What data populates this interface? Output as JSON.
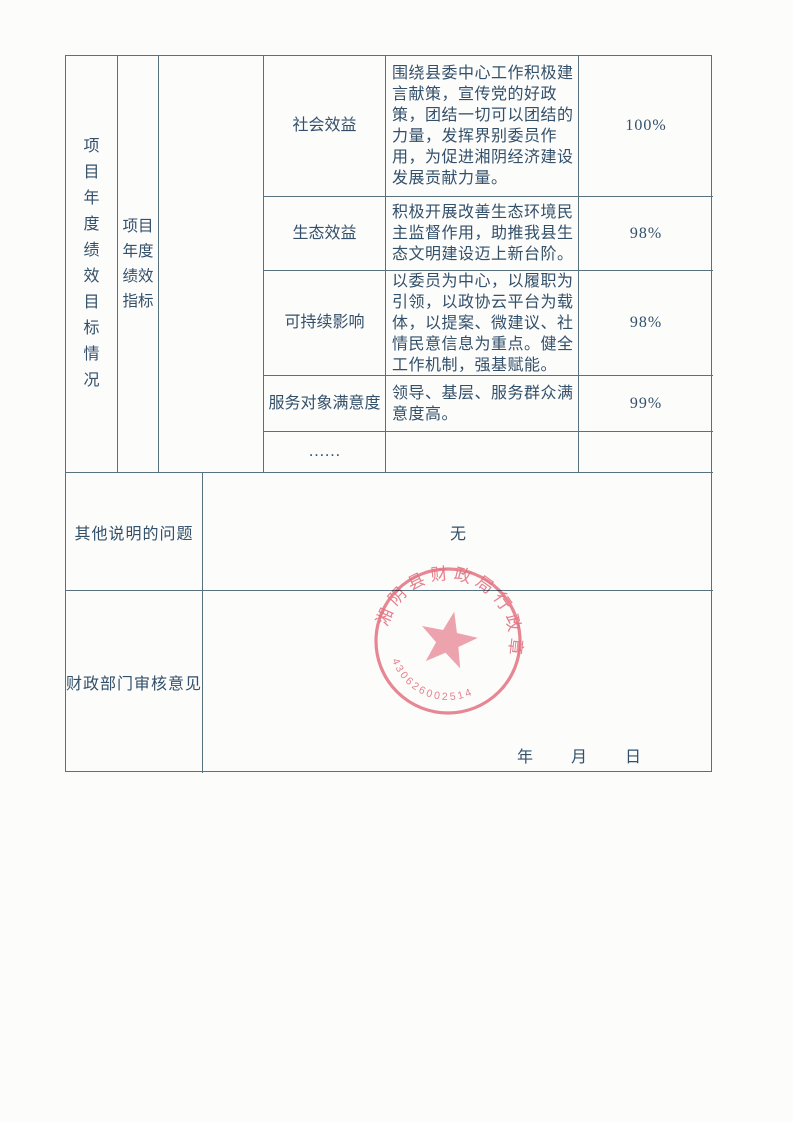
{
  "table": {
    "section_label": "项目年度绩效目标情况",
    "subsection_label": "项目年度绩效指标",
    "rows": [
      {
        "name": "社会效益",
        "description": "围绕县委中心工作积极建言献策，宣传党的好政策，团结一切可以团结的力量，发挥界别委员作用，为促进湘阴经济建设发展贡献力量。",
        "value": "100%"
      },
      {
        "name": "生态效益",
        "description": "积极开展改善生态环境民主监督作用，助推我县生态文明建设迈上新台阶。",
        "value": "98%"
      },
      {
        "name": "可持续影响",
        "description": "以委员为中心，以履职为引领，以政协云平台为载体，以提案、微建议、社情民意信息为重点。健全工作机制，强基赋能。",
        "value": "98%"
      },
      {
        "name": "服务对象满意度",
        "description": "领导、基层、服务群众满意度高。",
        "value": "99%"
      },
      {
        "name": "……",
        "description": "",
        "value": ""
      }
    ],
    "other": {
      "label": "其他说明的问题",
      "content": "无"
    },
    "review": {
      "label": "财政部门审核意见",
      "date_line": "年　　月　　日"
    }
  },
  "stamp": {
    "text": "湘阴县财政局行政章",
    "number": "4306260025145",
    "color": "#e26071"
  },
  "colors": {
    "ink": "#33506b",
    "border": "#57717f",
    "background": "#fcfcfb",
    "seal_red": "#e26071"
  }
}
